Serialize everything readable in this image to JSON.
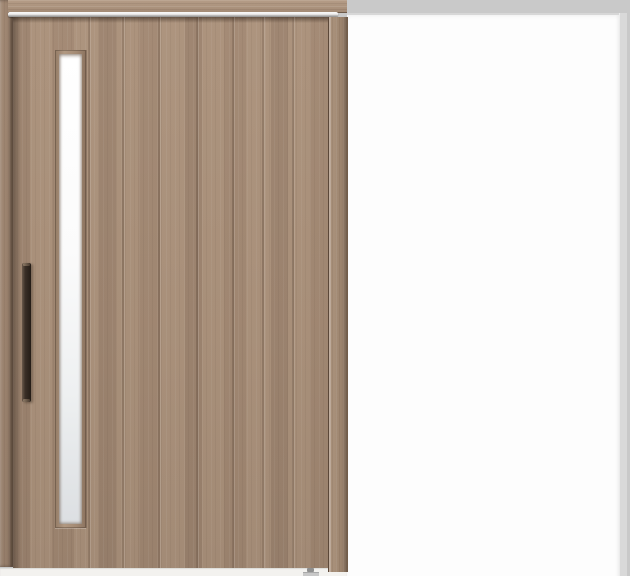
{
  "scene": {
    "type": "product-photo",
    "subject": "single sliding wooden door, closed panel on left with vertical frosted glass slit and dark bar handle, open white doorway on right",
    "parts": [
      "header-beam",
      "top-track",
      "left-door-frame",
      "door-panel",
      "glass-slit-window",
      "door-handle",
      "door-right-stile",
      "doorway-opening",
      "doorway-frame-right",
      "floor-strip",
      "floor-guide"
    ],
    "colors": {
      "backdrop": "#c9c9c9",
      "opening": "#fdfdfd",
      "frame_strip": "#d9d9d9",
      "wood_base": "#a68e79",
      "beam_light": "#b09881",
      "track_light": "#fafafa",
      "track_dark": "#8d8c8b",
      "glass_top": "#ffffff",
      "glass_bottom": "#dcdfe2",
      "handle_dark": "#241c16",
      "handle_light": "#6b5a4c",
      "floor": "#f3f2ef",
      "guide": "#8f8f8f",
      "guide_base": "#c8c8c8"
    }
  }
}
